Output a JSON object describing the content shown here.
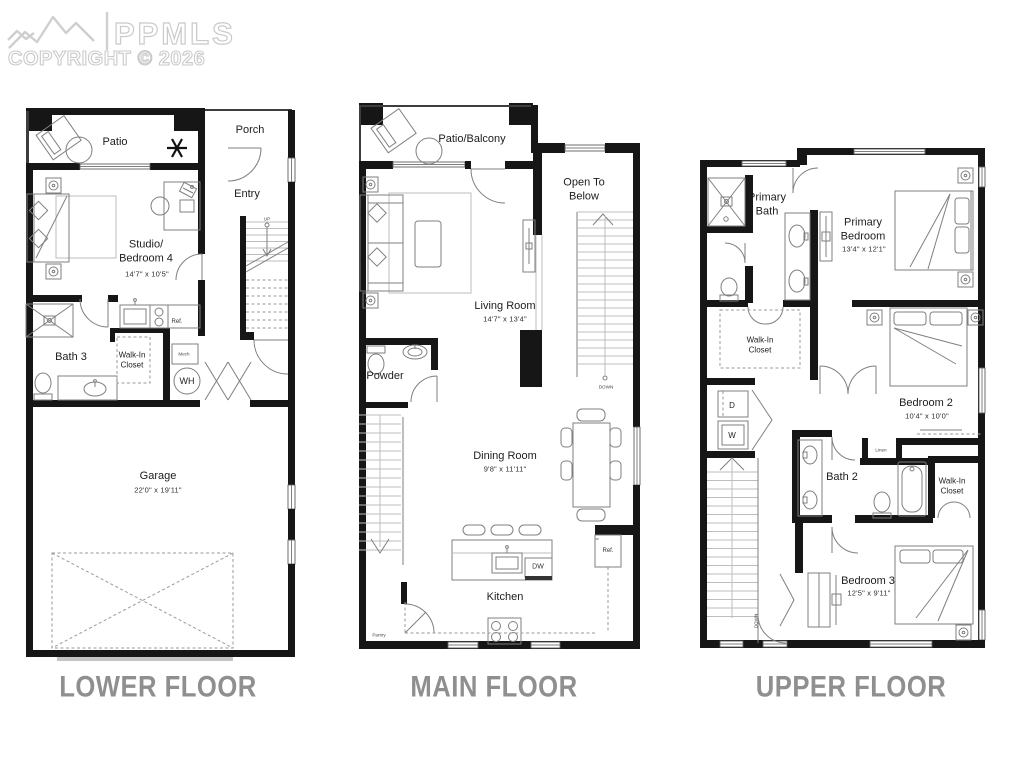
{
  "watermark": {
    "brand": "PPMLS",
    "copyright": "COPYRIGHT © 2026"
  },
  "floors": {
    "lower": {
      "title": "LOWER FLOOR",
      "rooms": {
        "patio": "Patio",
        "porch": "Porch",
        "entry": "Entry",
        "studio": "Studio/\nBedroom 4",
        "studio_dims": "14'7\" x 10'5\"",
        "bath3": "Bath 3",
        "walk_in_closet": "Walk-In\nCloset",
        "mech": "Mech",
        "water_heater": "WH",
        "ref": "Ref.",
        "up": "UP",
        "garage": "Garage",
        "garage_dims": "22'0\" x 19'11\""
      }
    },
    "main": {
      "title": "MAIN FLOOR",
      "rooms": {
        "patio_balcony": "Patio/Balcony",
        "open_to_below": "Open To\nBelow",
        "living": "Living Room",
        "living_dims": "14'7\" x 13'4\"",
        "powder": "Powder",
        "dining": "Dining Room",
        "dining_dims": "9'8\" x 11'11\"",
        "kitchen": "Kitchen",
        "dw": "DW",
        "ref": "Ref.",
        "pantry": "Pantry",
        "down": "DOWN"
      }
    },
    "upper": {
      "title": "UPPER FLOOR",
      "rooms": {
        "primary_bath": "Primary\nBath",
        "primary_bedroom": "Primary\nBedroom",
        "primary_bedroom_dims": "13'4\" x 12'1\"",
        "walk_in_closet_1": "Walk-In\nCloset",
        "dryer": "D",
        "washer": "W",
        "bedroom2": "Bedroom 2",
        "bedroom2_dims": "10'4\" x 10'0\"",
        "linen": "Linen",
        "bath2": "Bath 2",
        "walk_in_closet_2": "Walk-In\nCloset",
        "bedroom3": "Bedroom 3",
        "bedroom3_dims": "12'5\" x 9'11\"",
        "down": "DOWN"
      }
    }
  }
}
